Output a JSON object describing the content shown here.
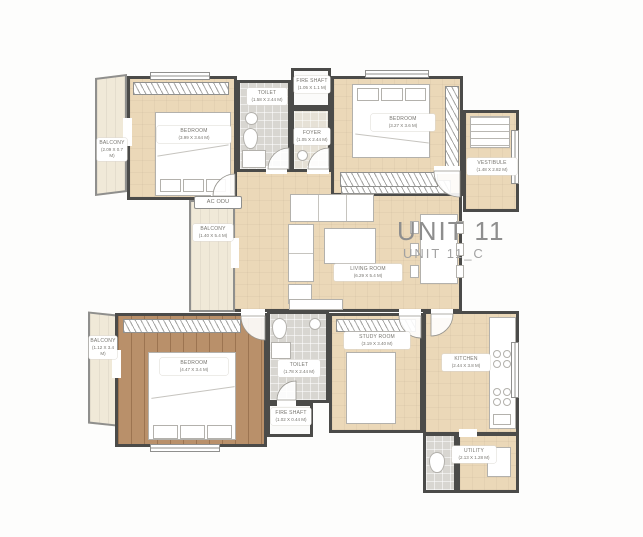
{
  "title": {
    "main": "UNIT 11",
    "sub": "UNIT 11_C"
  },
  "rooms": {
    "balcony_tl": {
      "name": "BALCONY",
      "dims": "(2.09 X 0.7 M)"
    },
    "bedroom_tl": {
      "name": "BEDROOM",
      "dims": "(3.99 X 3.64 M)"
    },
    "toilet_top": {
      "name": "TOILET",
      "dims": "(1.58 X 2.44 M)"
    },
    "fire_shaft_top": {
      "name": "FIRE SHAFT",
      "dims": "(1.05 X 1.1 M)"
    },
    "foyer": {
      "name": "FOYER",
      "dims": "(1.05 X 2.44 M)"
    },
    "bedroom_tr": {
      "name": "BEDROOM",
      "dims": "(3.27 X 3.6 M)"
    },
    "vestibule": {
      "name": "VESTIBULE",
      "dims": "(1.48 X 2.82 M)"
    },
    "ac_odu": {
      "name": "AC ODU"
    },
    "balcony_mid": {
      "name": "BALCONY",
      "dims": "(1.40 X 5.4 M)"
    },
    "living": {
      "name": "LIVING ROOM",
      "dims": "(6.29 X 5.4 M)"
    },
    "balcony_bl": {
      "name": "BALCONY",
      "dims": "(1.12 X 3.4 M)"
    },
    "bedroom_bl": {
      "name": "BEDROOM",
      "dims": "(4.47 X 3.4 M)"
    },
    "toilet_bot": {
      "name": "TOILET",
      "dims": "(1.78 X 2.44 M)"
    },
    "fire_shaft_bot": {
      "name": "FIRE SHAFT",
      "dims": "(1.02 X 0.44 M)"
    },
    "study": {
      "name": "STUDY ROOM",
      "dims": "(3.19 X 3.40 M)"
    },
    "kitchen": {
      "name": "KITCHEN",
      "dims": "(2.44 X 3.8 M)"
    },
    "utility": {
      "name": "UTILITY",
      "dims": "(2.13 X 1.28 M)"
    }
  },
  "colors": {
    "wall": "#4b4b49",
    "floor_beige": "#ebd8b8",
    "floor_wood": "#b9906a",
    "floor_tile": "#d8d6d1",
    "balcony": "#f0e9d8",
    "title_text": "#8e8e8e"
  }
}
